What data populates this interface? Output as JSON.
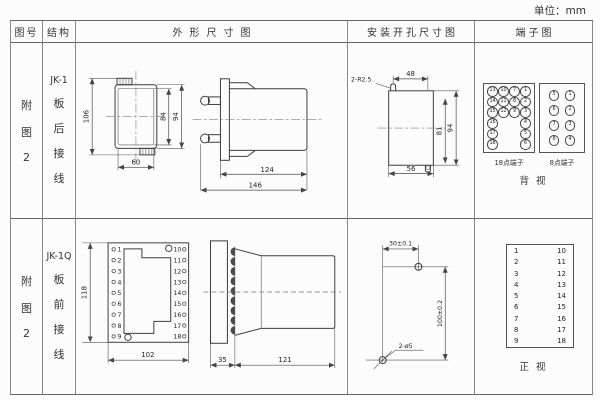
{
  "unit_label": "单位：mm",
  "header": {
    "fig_no": "图号",
    "structure": "结构",
    "outline": "外形尺寸图",
    "mounting": "安装开孔尺寸图",
    "terminal": "端子图"
  },
  "row1": {
    "fig_no_lines": [
      "附",
      "图",
      "2"
    ],
    "structure_lines": [
      "JK-1",
      "板",
      "后",
      "接",
      "线"
    ],
    "outline": {
      "front_height": "106",
      "front_inner_height": "84",
      "front_outer_height": "94",
      "front_width": "60",
      "side_body": "124",
      "side_total": "146"
    },
    "mounting": {
      "notch_label": "2-R2.5",
      "top_width": "48",
      "inner_height": "81",
      "outer_height": "94",
      "bottom_width": "56"
    },
    "terminal": {
      "grid18": [
        [
          "13",
          "10",
          "7",
          "1"
        ],
        [
          "14",
          "11",
          "8",
          "2"
        ],
        [
          "15",
          "12",
          "9",
          "3"
        ],
        [
          "16",
          "",
          "",
          "4"
        ],
        [
          "17",
          "",
          "",
          "5"
        ],
        [
          "18",
          "",
          "",
          "6"
        ]
      ],
      "label18": "18点端子",
      "grid8": [
        [
          "5",
          "1"
        ],
        [
          "6",
          "2"
        ],
        [
          "7",
          "3"
        ],
        [
          "8",
          "4"
        ]
      ],
      "label8": "8点端子",
      "view_label": "背 视"
    }
  },
  "row2": {
    "fig_no_lines": [
      "附",
      "图",
      "2"
    ],
    "structure_lines": [
      "JK-1Q",
      "板",
      "前",
      "接",
      "线"
    ],
    "outline": {
      "front_height": "118",
      "front_width": "102",
      "left_terminals": [
        "1",
        "2",
        "3",
        "4",
        "5",
        "6",
        "7",
        "8",
        "9"
      ],
      "right_terminals": [
        "10",
        "11",
        "12",
        "13",
        "14",
        "15",
        "16",
        "17",
        "18"
      ],
      "side_flange": "35",
      "side_body": "121"
    },
    "mounting": {
      "h_spacing": "30±0.1",
      "v_spacing": "100±0.2",
      "hole_label": "2-ø5"
    },
    "terminal": {
      "left_col": [
        "1",
        "2",
        "3",
        "4",
        "5",
        "6",
        "7",
        "8",
        "9"
      ],
      "right_col": [
        "10",
        "11",
        "12",
        "13",
        "14",
        "15",
        "16",
        "17",
        "18"
      ],
      "view_label": "正 视"
    }
  }
}
